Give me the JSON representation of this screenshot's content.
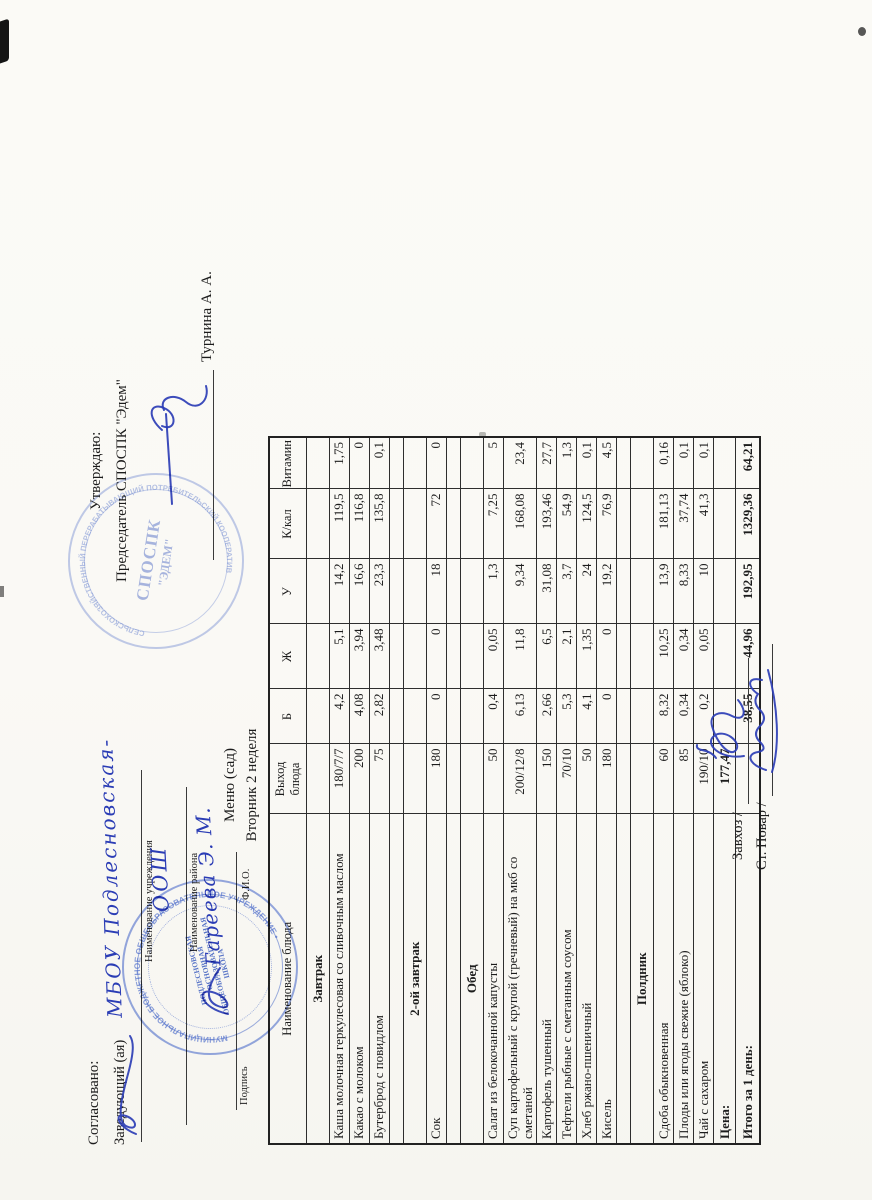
{
  "document": {
    "approval_left": {
      "title": "Согласовано:",
      "position_label": "Заведующий (ая)",
      "handwritten_institution": "МБОУ Подлесновская-",
      "institution_caption": "Наименование учреждения",
      "handwritten_institution2": "ООШ",
      "district_caption": "Наименование района",
      "handwritten_name": "Гареева Э. М.",
      "signature_caption": "Подпись",
      "fio_caption": "Ф.И.О."
    },
    "approval_right": {
      "title": "Утверждаю:",
      "position_line": "Председатель СПОСПК \"Эдем\"",
      "approver_name": "Турнина А. А."
    },
    "menu_title": "Меню (сад)",
    "menu_subtitle": "Вторник 2 неделя",
    "stamps": {
      "school": {
        "center_line1": "ПОДЛЕСНОВСКАЯ",
        "center_line2": "ОСНОВНАЯ",
        "center_line3": "ОБЩЕОБРАЗОВАТЕЛЬНАЯ",
        "center_line4": "ШКОЛА",
        "ring_text": "МУНИЦИПАЛЬНОЕ БЮДЖЕТНОЕ ОБЩЕОБРАЗОВАТЕЛЬНОЕ УЧРЕЖДЕНИЕ •",
        "color": "#3e60c6"
      },
      "edem": {
        "center_line1": "СПОСПК",
        "center_line2": "\"ЭДЕМ\"",
        "ring_text": "СЕЛЬСКОХОЗЯЙСТВЕННЫЙ ПЕРЕРАБАТЫВАЮЩИЙ ПОТРЕБИТЕЛЬСКИЙ КООПЕРАТИВ",
        "color": "#6c86cf"
      }
    },
    "footer": {
      "line1_label": "Завхоз /",
      "line2_label": "Ст. Повар /"
    },
    "ink_color": "#2b3db5"
  },
  "table": {
    "headers": [
      "Наименование блюда",
      "Выход блюда",
      "Б",
      "Ж",
      "У",
      "К/кал",
      "Витамин С"
    ],
    "rows": [
      {
        "type": "section",
        "name": "Завтрак"
      },
      {
        "type": "dish",
        "name": "Каша молочная геркулесовая со сливочным маслом",
        "out": "180/7/7",
        "b": "4,2",
        "zh": "5,1",
        "u": "14,2",
        "kcal": "119,5",
        "vit": "1,75"
      },
      {
        "type": "dish",
        "name": "Какао с молоком",
        "out": "200",
        "b": "4,08",
        "zh": "3,94",
        "u": "16,6",
        "kcal": "116,8",
        "vit": "0"
      },
      {
        "type": "dish",
        "name": "Бутерброд с повидлом",
        "out": "75",
        "b": "2,82",
        "zh": "3,48",
        "u": "23,3",
        "kcal": "135,8",
        "vit": "0,1"
      },
      {
        "type": "empty"
      },
      {
        "type": "section",
        "name": "2-ой завтрак"
      },
      {
        "type": "dish",
        "name": "Сок",
        "out": "180",
        "b": "0",
        "zh": "0",
        "u": "18",
        "kcal": "72",
        "vit": "0"
      },
      {
        "type": "empty"
      },
      {
        "type": "section",
        "name": "Обед"
      },
      {
        "type": "dish",
        "name": "Салат из белокочанной капусты",
        "out": "50",
        "b": "0,4",
        "zh": "0,05",
        "u": "1,3",
        "kcal": "7,25",
        "vit": "5"
      },
      {
        "type": "dish",
        "name": "Суп картофельный с крупой (гречневый) на мкб со сметаной",
        "out": "200/12/8",
        "b": "6,13",
        "zh": "11,8",
        "u": "9,34",
        "kcal": "168,08",
        "vit": "23,4"
      },
      {
        "type": "dish",
        "name": "Картофель тушенный",
        "out": "150",
        "b": "2,66",
        "zh": "6,5",
        "u": "31,08",
        "kcal": "193,46",
        "vit": "27,7"
      },
      {
        "type": "dish",
        "name": "Тефтели рыбные с сметанным соусом",
        "out": "70/10",
        "b": "5,3",
        "zh": "2,1",
        "u": "3,7",
        "kcal": "54,9",
        "vit": "1,3"
      },
      {
        "type": "dish",
        "name": "Хлеб ржано-пшеничный",
        "out": "50",
        "b": "4,1",
        "zh": "1,35",
        "u": "24",
        "kcal": "124,5",
        "vit": "0,1"
      },
      {
        "type": "dish",
        "name": "Кисель",
        "out": "180",
        "b": "0",
        "zh": "0",
        "u": "19,2",
        "kcal": "76,9",
        "vit": "4,5"
      },
      {
        "type": "empty"
      },
      {
        "type": "section",
        "name": "Полдник"
      },
      {
        "type": "dish",
        "name": "Сдоба обыкновенная",
        "out": "60",
        "b": "8,32",
        "zh": "10,25",
        "u": "13,9",
        "kcal": "181,13",
        "vit": "0,16"
      },
      {
        "type": "dish",
        "name": "Плоды или ягоды свежие (яблоко)",
        "out": "85",
        "b": "0,34",
        "zh": "0,34",
        "u": "8,33",
        "kcal": "37,74",
        "vit": "0,1"
      },
      {
        "type": "dish",
        "name": "Чай с сахаром",
        "out": "190/10",
        "b": "0,2",
        "zh": "0,05",
        "u": "10",
        "kcal": "41,3",
        "vit": "0,1"
      },
      {
        "type": "price",
        "name": "Цена:",
        "out": "177,47"
      },
      {
        "type": "total",
        "name": "Итого за 1 день:",
        "b": "38,55",
        "zh": "44,96",
        "u": "192,95",
        "kcal": "1329,36",
        "vit": "64,21"
      }
    ]
  }
}
